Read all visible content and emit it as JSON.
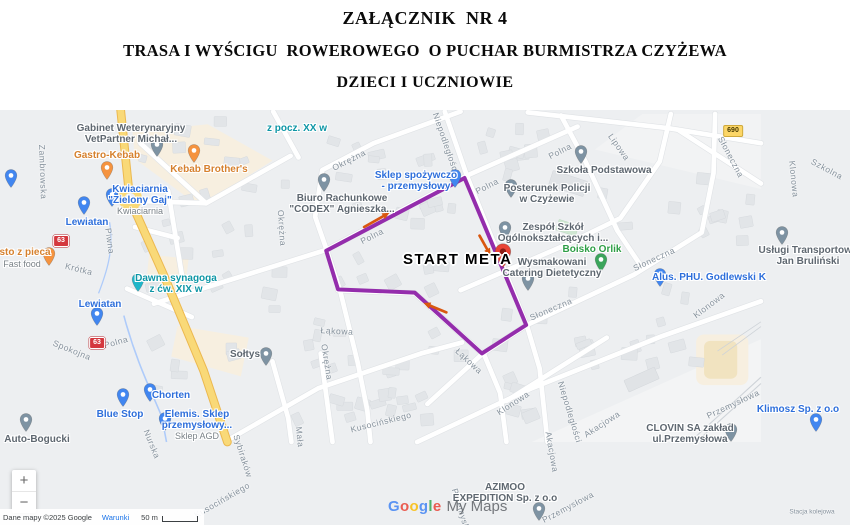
{
  "title": {
    "line1": "ZAŁĄCZNIK  NR 4",
    "line2": "TRASA I WYŚCIGU  ROWEROWEGO  O PUCHAR BURMISTRZA CZYŻEWA",
    "line3": "DZIECI I UCZNIOWIE"
  },
  "map": {
    "route": {
      "color": "#8b1ba5",
      "width": 5,
      "points": [
        [
          475,
          196
        ],
        [
          300,
          288
        ],
        [
          315,
          337
        ],
        [
          412,
          341
        ],
        [
          497,
          418
        ],
        [
          553,
          382
        ],
        [
          475,
          196
        ]
      ]
    },
    "start": {
      "label": "START META",
      "x": 403,
      "y": 251,
      "pin_x": 503,
      "pin_y": 268,
      "pin_color": "#e94335"
    },
    "arrows": {
      "color": "#d9570f",
      "items": [
        {
          "x1": 348,
          "y1": 258,
          "x2": 380,
          "y2": 240
        },
        {
          "x1": 494,
          "y1": 269,
          "x2": 508,
          "y2": 294
        },
        {
          "x1": 452,
          "y1": 366,
          "x2": 423,
          "y2": 354
        }
      ]
    },
    "badges": [
      {
        "text": "63",
        "style": "national",
        "x": 61,
        "y": 241
      },
      {
        "text": "63",
        "style": "national",
        "x": 97,
        "y": 343
      },
      {
        "text": "690",
        "style": "regional",
        "x": 733,
        "y": 131
      }
    ],
    "streets": [
      {
        "name": "Zambrowska",
        "x": 43,
        "y": 172,
        "r": 88
      },
      {
        "name": "Piwna",
        "x": 110,
        "y": 241,
        "r": 82
      },
      {
        "name": "Krótka",
        "x": 79,
        "y": 269,
        "r": 14
      },
      {
        "name": "Spokojna",
        "x": 72,
        "y": 350,
        "r": 22
      },
      {
        "name": "Polna",
        "x": 116,
        "y": 342,
        "r": -16
      },
      {
        "name": "Polna",
        "x": 372,
        "y": 236,
        "r": -27
      },
      {
        "name": "Polna",
        "x": 487,
        "y": 186,
        "r": -27
      },
      {
        "name": "Polna",
        "x": 560,
        "y": 151,
        "r": -27
      },
      {
        "name": "Okrężna",
        "x": 349,
        "y": 160,
        "r": -27
      },
      {
        "name": "Okrężna",
        "x": 282,
        "y": 228,
        "r": 86
      },
      {
        "name": "Okrężna",
        "x": 327,
        "y": 362,
        "r": 81
      },
      {
        "name": "Nurska",
        "x": 152,
        "y": 444,
        "r": 68
      },
      {
        "name": "Niepodległości",
        "x": 446,
        "y": 143,
        "r": 71
      },
      {
        "name": "Niepodległości",
        "x": 570,
        "y": 412,
        "r": 73
      },
      {
        "name": "Łąkowa",
        "x": 337,
        "y": 331,
        "r": 3
      },
      {
        "name": "Łąkowa",
        "x": 469,
        "y": 361,
        "r": 43
      },
      {
        "name": "Kusocińskiego",
        "x": 222,
        "y": 500,
        "r": -30
      },
      {
        "name": "Kusocińskiego",
        "x": 381,
        "y": 422,
        "r": -14
      },
      {
        "name": "Mała",
        "x": 300,
        "y": 437,
        "r": 84
      },
      {
        "name": "Sybiraków",
        "x": 243,
        "y": 456,
        "r": 72
      },
      {
        "name": "Lipowa",
        "x": 619,
        "y": 147,
        "r": 55
      },
      {
        "name": "Słoneczna",
        "x": 731,
        "y": 157,
        "r": 62
      },
      {
        "name": "Słoneczna",
        "x": 654,
        "y": 259,
        "r": -25
      },
      {
        "name": "Słoneczna",
        "x": 551,
        "y": 309,
        "r": -23
      },
      {
        "name": "Szkolna",
        "x": 827,
        "y": 169,
        "r": 28
      },
      {
        "name": "Klonowa",
        "x": 794,
        "y": 179,
        "r": 84
      },
      {
        "name": "Klonowa",
        "x": 709,
        "y": 305,
        "r": -37
      },
      {
        "name": "Klonowa",
        "x": 513,
        "y": 403,
        "r": -33
      },
      {
        "name": "Akacjowa",
        "x": 602,
        "y": 424,
        "r": -33
      },
      {
        "name": "Akacjowa",
        "x": 552,
        "y": 452,
        "r": 80
      },
      {
        "name": "Przemysłowa",
        "x": 733,
        "y": 404,
        "r": -25
      },
      {
        "name": "Przemysłowa",
        "x": 568,
        "y": 507,
        "r": -28
      },
      {
        "name": "Przemysłowa",
        "x": 463,
        "y": 516,
        "r": 73
      },
      {
        "name": "Stacja kolejowa",
        "x": 812,
        "y": 512,
        "r": 0,
        "tiny": true
      }
    ],
    "pois": [
      {
        "id": "vetpartner",
        "lines": [
          "Gabinet Weterynaryjny",
          "VetPartner Michał..."
        ],
        "color": "grey",
        "tx": 131,
        "ty": 124,
        "px": 157,
        "py": 157
      },
      {
        "id": "gastro-kebab",
        "lines": [
          "Gastro-Kebab"
        ],
        "color": "orange",
        "tx": 107,
        "ty": 151,
        "px": 107,
        "py": 180
      },
      {
        "id": "kebab-brothers",
        "lines": [
          "Kebab Brother's"
        ],
        "color": "orange",
        "tx": 209,
        "ty": 165,
        "px": 194,
        "py": 163
      },
      {
        "id": "kwiaciarnia-zielony-gaj",
        "lines": [
          "Kwiaciarnia",
          "\"Zielony Gaj\""
        ],
        "sub": "Kwiaciarnia",
        "color": "blue",
        "tx": 140,
        "ty": 185,
        "px": 112,
        "py": 207
      },
      {
        "id": "lewiatan-north",
        "lines": [
          "Lewiatan"
        ],
        "color": "blue",
        "tx": 87,
        "ty": 218,
        "px": 84,
        "py": 215
      },
      {
        "id": "lewiatan-south",
        "lines": [
          "Lewiatan"
        ],
        "color": "blue",
        "tx": 100,
        "ty": 300,
        "px": 97,
        "py": 326
      },
      {
        "id": "prosto-z-pieca",
        "lines": [
          "osto z pieca"
        ],
        "sub": "Fast food",
        "color": "orange",
        "tx": 22,
        "ty": 248,
        "px": 49,
        "py": 266
      },
      {
        "id": "dawna-synagoga",
        "lines": [
          "Dawna synagoga",
          "z ćw. XIX w"
        ],
        "color": "teal",
        "tx": 176,
        "ty": 274,
        "px": 138,
        "py": 292
      },
      {
        "id": "z-pocz-xx-w",
        "lines": [
          "z pocz. XX w"
        ],
        "color": "teal",
        "tx": 297,
        "ty": 124
      },
      {
        "id": "sklep-spozywczo",
        "lines": [
          "Sklep spożywczo",
          "- przemysłowy"
        ],
        "color": "blue",
        "tx": 416,
        "ty": 171,
        "px": 455,
        "py": 188
      },
      {
        "id": "biuro-codex",
        "lines": [
          "Biuro Rachunkowe",
          "\"CODEX\"  Agnieszka..."
        ],
        "color": "grey",
        "tx": 342,
        "ty": 194,
        "px": 324,
        "py": 192
      },
      {
        "id": "posterunek-policji",
        "lines": [
          "Posterunek Policji",
          "w Czyżewie"
        ],
        "color": "grey",
        "tx": 547,
        "ty": 184,
        "px": 511,
        "py": 198
      },
      {
        "id": "zespol-szkol",
        "lines": [
          "Zespół Szkół",
          "Ogólnokształcących i..."
        ],
        "color": "grey",
        "tx": 553,
        "ty": 223,
        "px": 505,
        "py": 240
      },
      {
        "id": "boisko-orlik",
        "lines": [
          "Boisko Orlik"
        ],
        "color": "green",
        "tx": 592,
        "ty": 245,
        "px": 601,
        "py": 272
      },
      {
        "id": "wysmakowani-catering",
        "lines": [
          "Wysmakowani",
          "Catering Dietetyczny"
        ],
        "color": "grey",
        "tx": 552,
        "ty": 258,
        "px": 528,
        "py": 291
      },
      {
        "id": "szkola-podstawowa",
        "lines": [
          "Szkoła Podstawowa"
        ],
        "color": "grey",
        "tx": 604,
        "ty": 166,
        "px": 581,
        "py": 164
      },
      {
        "id": "uslugi-transportowe",
        "lines": [
          "Usługi Transportowe",
          "Jan Bruliński"
        ],
        "color": "grey",
        "tx": 808,
        "ty": 246,
        "px": 782,
        "py": 245
      },
      {
        "id": "alus-phu",
        "lines": [
          "Alus. PHU. Godlewski K"
        ],
        "color": "blue",
        "tx": 709,
        "ty": 273,
        "px": 660,
        "py": 287
      },
      {
        "id": "soltys",
        "lines": [
          "Sołtys"
        ],
        "color": "grey",
        "tx": 245,
        "ty": 350,
        "px": 266,
        "py": 366
      },
      {
        "id": "auto-bogucki",
        "lines": [
          "Auto-Bogucki"
        ],
        "color": "grey",
        "tx": 37,
        "ty": 435,
        "px": 26,
        "py": 432
      },
      {
        "id": "chorten",
        "lines": [
          "Chorten"
        ],
        "color": "blue",
        "tx": 171,
        "ty": 391,
        "px": 150,
        "py": 402
      },
      {
        "id": "blue-stop",
        "lines": [
          "Blue Stop"
        ],
        "color": "blue",
        "tx": 120,
        "ty": 410,
        "px": 123,
        "py": 407
      },
      {
        "id": "elemis",
        "lines": [
          "Elemis. Sklep",
          "przemysłowy..."
        ],
        "sub": "Sklep AGD",
        "color": "blue",
        "tx": 197,
        "ty": 410,
        "px": 165,
        "py": 431
      },
      {
        "id": "clovin",
        "lines": [
          "CLOVIN SA zakład",
          "ul.Przemysłowa"
        ],
        "color": "grey",
        "tx": 690,
        "ty": 424,
        "px": 731,
        "py": 442
      },
      {
        "id": "klimosz",
        "lines": [
          "Klimosz Sp. z o.o"
        ],
        "color": "blue",
        "tx": 798,
        "ty": 405,
        "px": 816,
        "py": 432
      },
      {
        "id": "azimoo-expedition",
        "lines": [
          "AZIMOO",
          "EXPEDITION Sp. z o.o"
        ],
        "color": "grey",
        "tx": 505,
        "ty": 483,
        "px": 539,
        "py": 521
      },
      {
        "id": "edge-pin",
        "lines": [],
        "color": "blue",
        "px": 11,
        "py": 188
      }
    ],
    "controls": {
      "zoom_in": "+",
      "zoom_out": "−"
    },
    "watermark": {
      "part1": "Google",
      "part2": "My Maps"
    },
    "attribution": {
      "copyright": "Dane mapy ©2025 Google",
      "terms": "Warunki",
      "scale_label": "50 m"
    }
  }
}
